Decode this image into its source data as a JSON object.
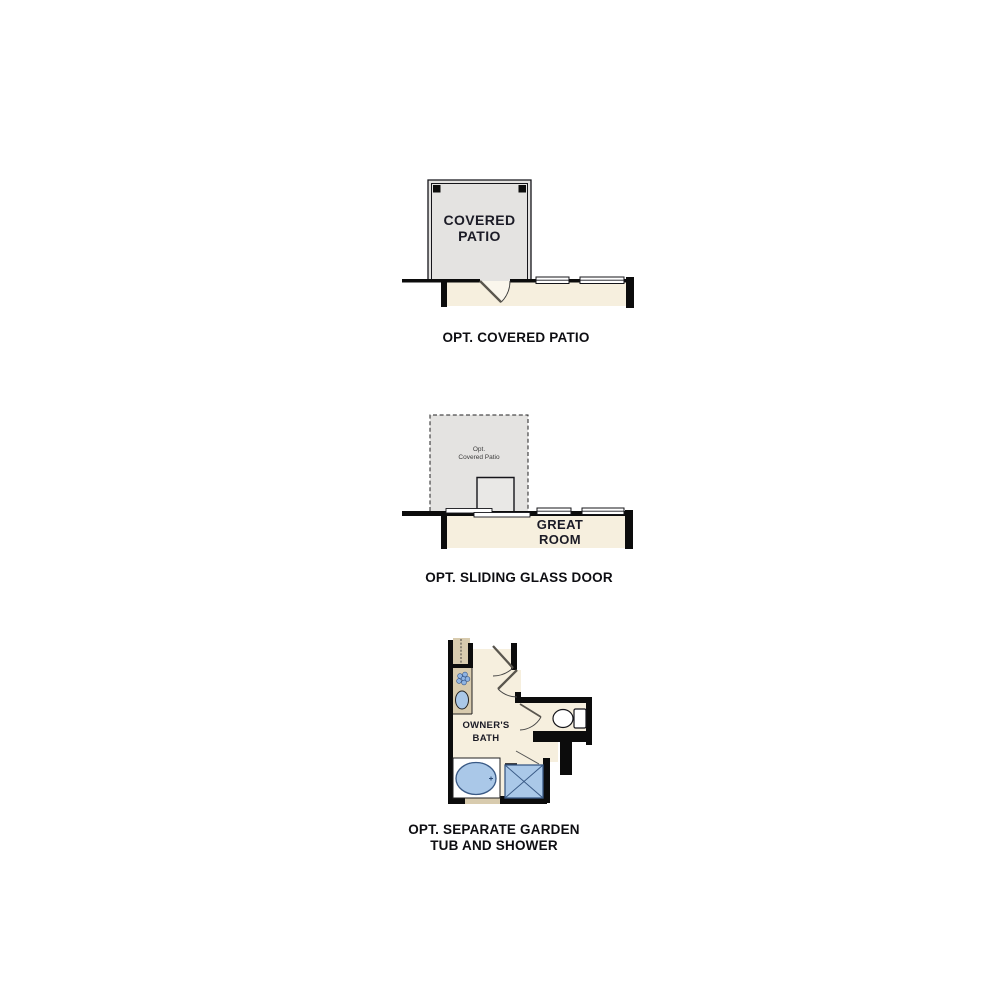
{
  "page": {
    "background": "#ffffff",
    "type": "floor-plan-options-sheet"
  },
  "colors": {
    "wall": "#0c0c0c",
    "line": "#15151a",
    "patio_fill": "#e4e3e1",
    "interior_fill": "#f6efde",
    "counter_fill": "#d8cbae",
    "fixture_fill": "#aac8e8",
    "fixture_stroke": "#3a5a86",
    "label": "#1b1b26",
    "caption": "#0e0e12"
  },
  "figures": [
    {
      "id": "opt-covered-patio",
      "room_label_lines": [
        "COVERED",
        "PATIO"
      ],
      "caption": "OPT. COVERED PATIO"
    },
    {
      "id": "opt-sliding-glass-door",
      "patio_label_lines": [
        "Opt.",
        "Covered Patio"
      ],
      "room_label_lines": [
        "GREAT",
        "ROOM"
      ],
      "caption": "OPT. SLIDING GLASS DOOR"
    },
    {
      "id": "opt-separate-garden-tub-and-shower",
      "room_label_lines": [
        "OWNER'S",
        "BATH"
      ],
      "caption_lines": [
        "OPT. SEPARATE GARDEN",
        "TUB AND SHOWER"
      ]
    }
  ]
}
